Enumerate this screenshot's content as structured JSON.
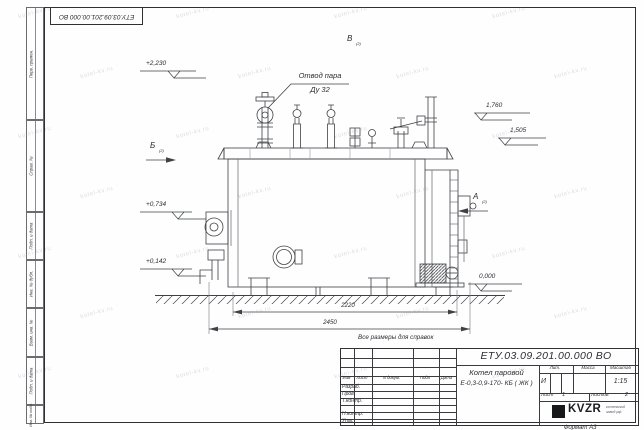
{
  "sheet": {
    "watermark_text": "kotel-kv.ru",
    "format_note": "Формат А3",
    "reference_note": "Все размеры для справок",
    "stamp_number": "ЕТУ.03.09.201.00.000  ВО"
  },
  "margin_labels": [
    "Перв. примен.",
    "Справ. №",
    "Подп. и дата",
    "Инв. № дубл.",
    "Взам. инв. №",
    "Подп. и дата",
    "Инв. № подл."
  ],
  "drawing": {
    "callout_line1": "Отвод пара",
    "callout_line2": "Ду 32",
    "views": {
      "left": "Б",
      "top": "В",
      "right": "А",
      "suffix": "(2)"
    },
    "elevations": {
      "top": "+2,230",
      "steam": "1,760",
      "mid": "1,505",
      "burner": "+0,734",
      "low": "+0,142",
      "ground": "0,000"
    },
    "dimensions": {
      "inner": "2220",
      "overall": "2450"
    }
  },
  "title_block": {
    "doc_number": "ЕТУ.03.09.201.00.000  ВО",
    "name_line1": "Котел паровой",
    "name_line2": "Е-0,3-0,9-170- КБ ( ЖК )",
    "col_izm": "Изм",
    "col_list": "Лист",
    "col_ndoc": "N докум.",
    "col_podp": "Подп",
    "col_data": "Дата",
    "row_razrab": "Разраб.",
    "row_prov": "Пров.",
    "row_tkontr": "Т.контр.",
    "row_nkontr": "Н.контр.",
    "row_utv": "Утв.",
    "lit_header": "Лит.",
    "mass_header": "Масса",
    "scale_header": "Масштаб",
    "lit_value": "И",
    "scale_value": "1:15",
    "sheet_label": "Лист",
    "sheet_value": "1",
    "sheets_label": "Листов",
    "sheets_value": "2",
    "logo_text": "KVZR",
    "logo_sub1": "котельный",
    "logo_sub2": "завод рф"
  }
}
